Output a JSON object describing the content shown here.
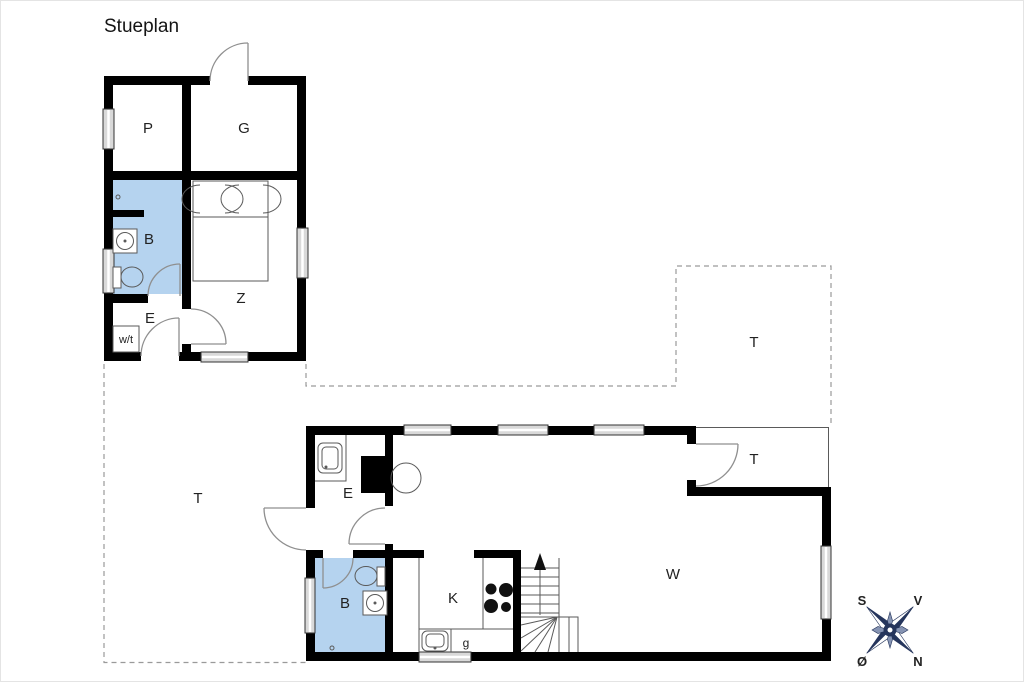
{
  "title": "Stueplan",
  "colors": {
    "wall": "#000000",
    "bathroom_fill": "#b5d3ef",
    "compass": "#25355c",
    "compass_light": "#8694b3"
  },
  "annex": {
    "storage": "P",
    "guest_room": "G",
    "bathroom": "B",
    "bedroom": "Z",
    "entry": "E",
    "utility": "w/t"
  },
  "main": {
    "entry": "E",
    "bathroom": "B",
    "kitchen": "K",
    "appliance": "g",
    "living_room": "W",
    "covered_terrace": "T"
  },
  "terraces": {
    "west": "T",
    "northeast": "T"
  },
  "compass": {
    "south": "S",
    "west": "V",
    "east": "Ø",
    "north": "N"
  }
}
